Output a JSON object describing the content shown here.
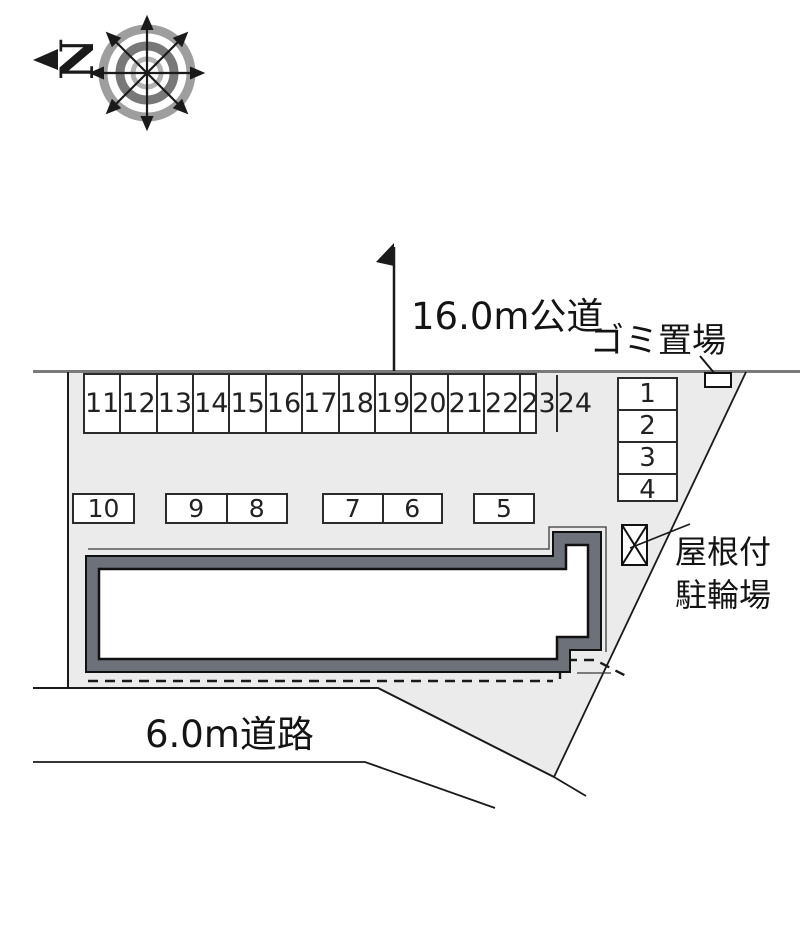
{
  "diagram_type": "site-plan",
  "compass": {
    "north_label": "N"
  },
  "labels": {
    "road_top": "16.0m公道",
    "road_bottom": "6.0m道路",
    "garbage": "ゴミ置場",
    "bicycle_line1": "屋根付",
    "bicycle_line2": "駐輪場"
  },
  "parking": {
    "row_top": [
      "11",
      "12",
      "13",
      "14",
      "15",
      "16",
      "17",
      "18",
      "19",
      "20",
      "21",
      "22",
      "23",
      "24"
    ],
    "row_mid": [
      [
        "10"
      ],
      [
        "9",
        "8"
      ],
      [
        "7",
        "6"
      ],
      [
        "5"
      ]
    ],
    "column_right": [
      "1",
      "2",
      "3",
      "4"
    ]
  },
  "colors": {
    "plot_fill": "#ebebeb",
    "building_wall": "#6d7179",
    "line": "#1a1a1a",
    "road_line": "#7a7a7a"
  }
}
